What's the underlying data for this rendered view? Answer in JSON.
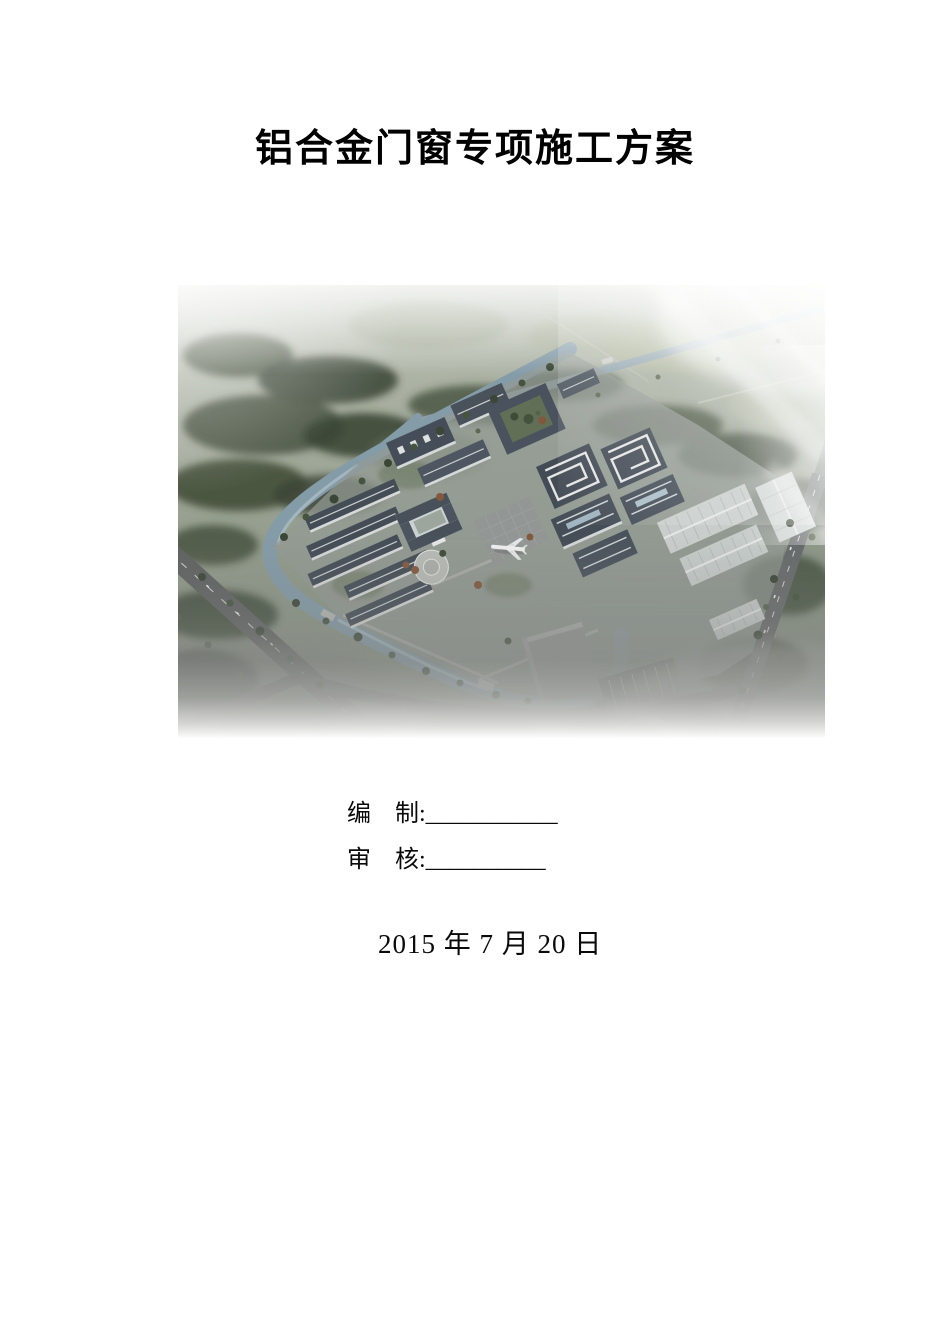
{
  "document": {
    "title": "铝合金门窗专项施工方案",
    "prepared": {
      "label": "编　制:",
      "blank": "___________"
    },
    "reviewed": {
      "label": "审　核:",
      "blank": "__________"
    },
    "date": "2015 年 7 月 20 日"
  },
  "figure": {
    "alt": "工业园区鸟瞰效果图",
    "colors": {
      "water": "#7e97a6",
      "forest_dark": "#303b2b",
      "roof_dark": "#3a4450",
      "facade_light": "#ccd1d2",
      "road": "#57595a",
      "warehouse": "#c9cfce",
      "mist": "#ffffff"
    }
  }
}
